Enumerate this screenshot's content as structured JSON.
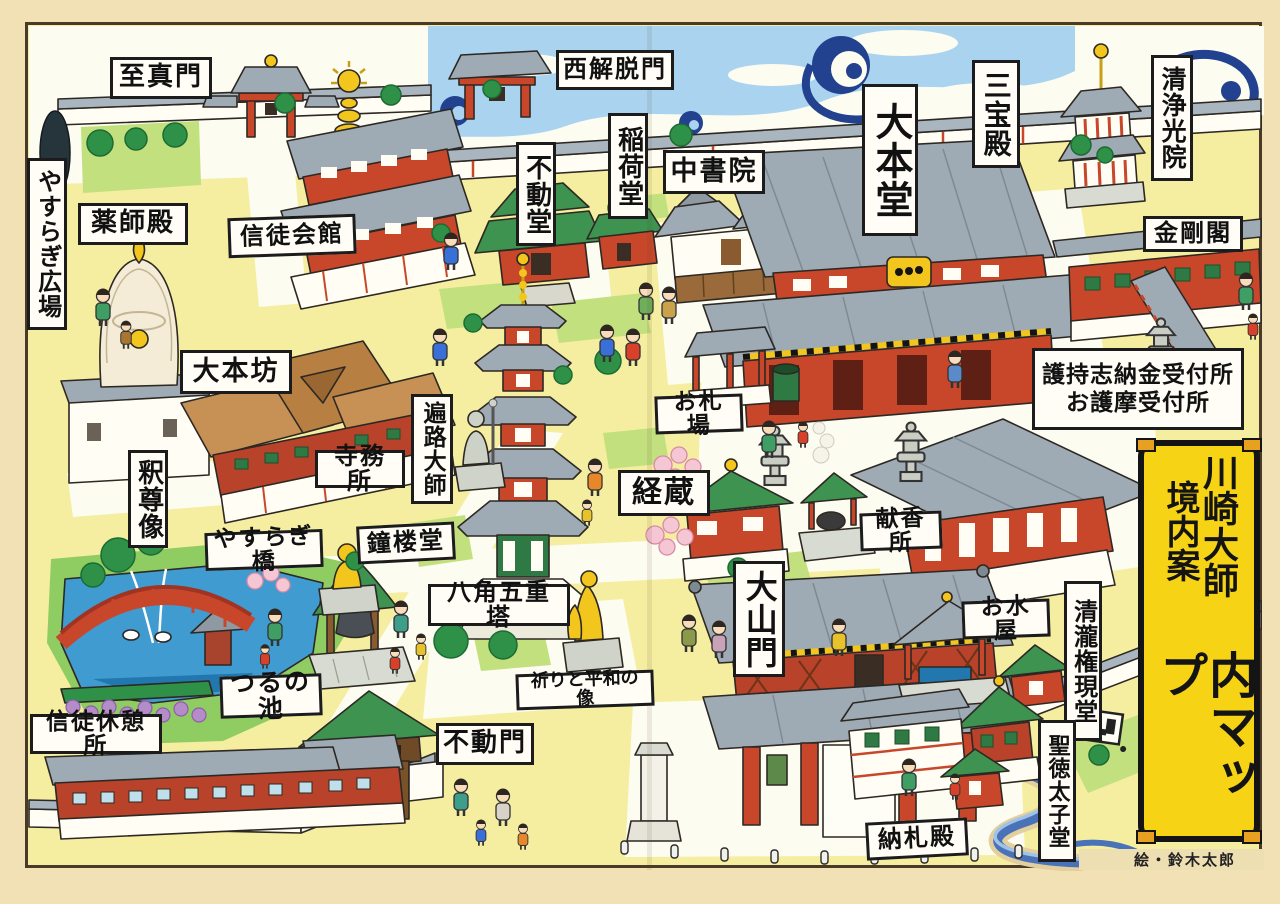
{
  "banner": {
    "title_full": "川崎大師境内案内マップ",
    "col_right": "川崎大師",
    "col_left": "境内案",
    "col_bottom": "内マップ"
  },
  "credit": "絵・鈴木太郎",
  "labels": {
    "shijinmon": "至真門",
    "yasuragi_hiroba": "やすらぎ広場",
    "yakushiden": "薬師殿",
    "shinto_kaikan": "信徒会館",
    "nishi_gedatsumon": "西解脱門",
    "fudodo": "不動堂",
    "inarido": "稲荷堂",
    "chushoin": "中書院",
    "daihondo": "大本堂",
    "sanboden": "三宝殿",
    "seijo_koin": "清浄光院",
    "kongokaku": "金剛閣",
    "daihonbo": "大本坊",
    "jimusho": "寺務所",
    "henro_daishi": "遍路大師",
    "shakusonzo": "釈尊像",
    "yasuragibashi": "やすらぎ橋",
    "shorodo": "鐘楼堂",
    "hakkaku_gojunoto": "八角五重塔",
    "kyozo": "経蔵",
    "ofudaba": "お札場",
    "reception_line1": "護持志納金受付所",
    "reception_line2": "お護摩受付所",
    "kenkosho": "献香所",
    "daisanmon": "大山門",
    "omizuya": "お水屋",
    "seiryu_gongendo": "清瀧権現堂",
    "shotoku_taishido": "聖徳太子堂",
    "nosatsuden": "納札殿",
    "inori_to_heiwa": "祈りと平和の像",
    "fudomon": "不動門",
    "tsurunoike": "つるの池",
    "shinto_kyukeijo": "信徒休憩所"
  },
  "colors": {
    "page_bg": "#f1e1b5",
    "ground": "#f5eea0",
    "plaza_white": "#fdfcf1",
    "sky_blue": "#a9d3ee",
    "cloud_navy": "#22418f",
    "banner_yellow": "#f6d415",
    "roof_gray": "#9fabb4",
    "roof_green": "#3e9350",
    "roof_brown": "#c79055",
    "wall_red": "#c8472b",
    "pond_blue": "#3f9bd0",
    "gold": "#f2c61d"
  }
}
